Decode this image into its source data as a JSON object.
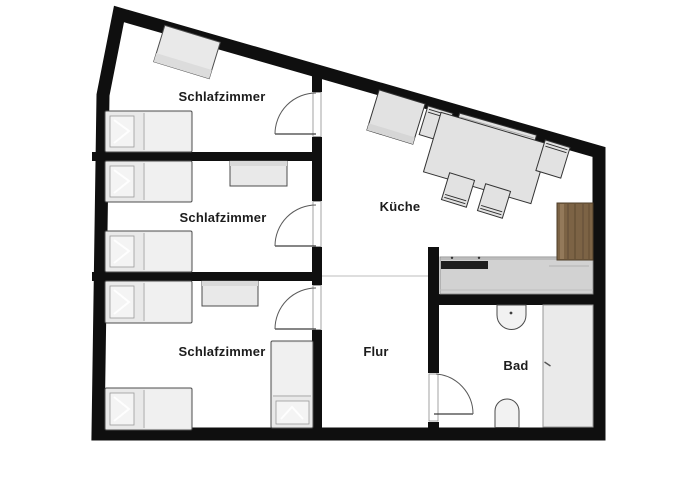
{
  "plan": {
    "type": "apartment-floor-plan",
    "background": "#ffffff"
  },
  "rooms": [
    {
      "id": "schlafzimmer-top",
      "label": "Schlafzimmer"
    },
    {
      "id": "schlafzimmer-middle",
      "label": "Schlafzimmer"
    },
    {
      "id": "schlafzimmer-bottom",
      "label": "Schlafzimmer"
    },
    {
      "id": "kueche",
      "label": "Küche"
    },
    {
      "id": "flur",
      "label": "Flur"
    },
    {
      "id": "bad",
      "label": "Bad"
    }
  ],
  "colors": {
    "wall": "#0f0f0f",
    "furniture_fill": "#e9e9e9",
    "furniture_stroke": "#4d4d4d",
    "counter_fill": "#d2d2d2",
    "stove_black": "#1e1e1e",
    "wood_cabinet": "#7c6345",
    "wood_grain": "#5d4830",
    "shower_fill": "#eaeaea",
    "fixture_fill": "#f2f2f2",
    "open_boundary_line": "#c9c9c9",
    "label_text": "#1c1c1c"
  }
}
